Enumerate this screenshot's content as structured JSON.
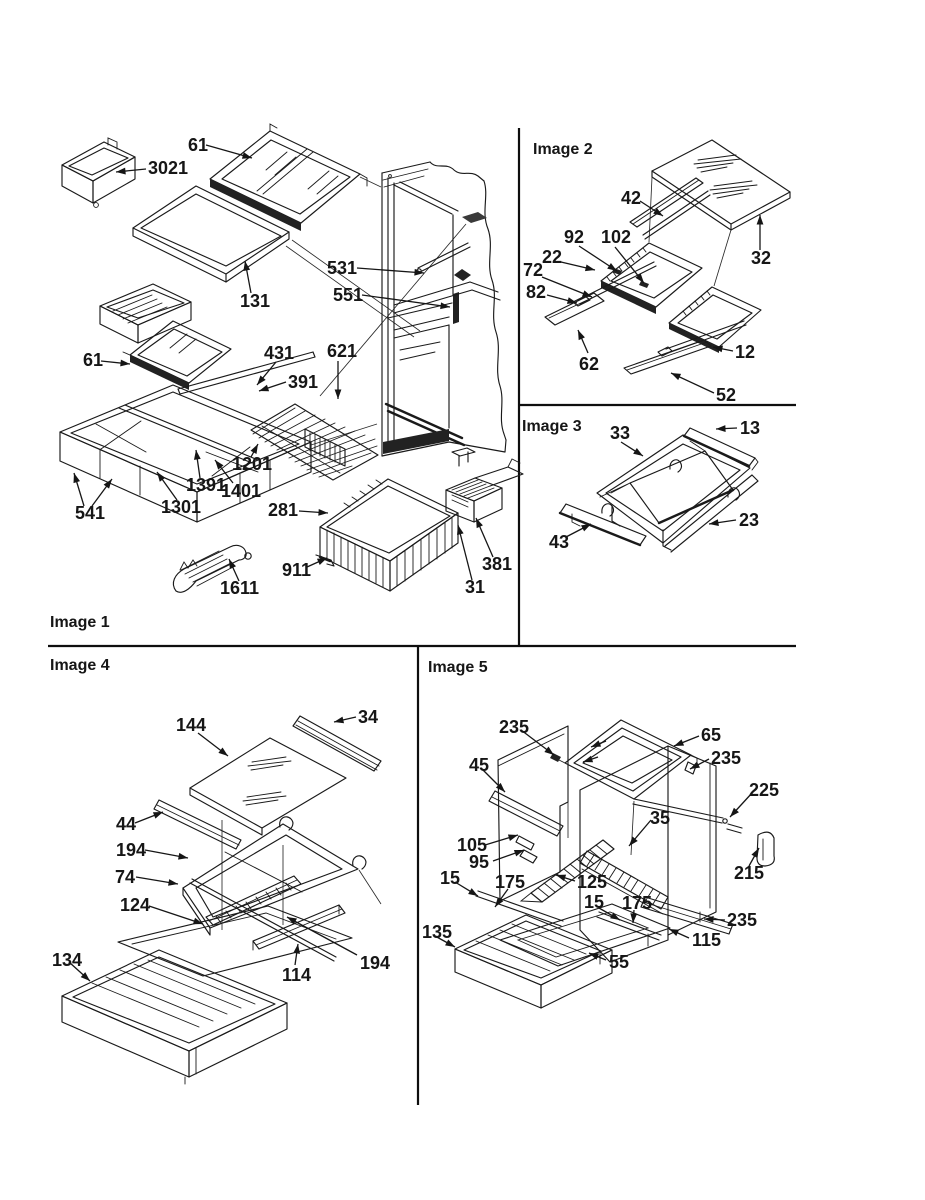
{
  "document": {
    "kind": "appliance exploded parts diagram (scanned line art)",
    "background": "#ffffff",
    "ink": "#1a1a1a"
  },
  "panels": [
    {
      "id": "image-1",
      "label": "Image 1",
      "parts": [
        "61",
        "3021",
        "131",
        "531",
        "551",
        "431",
        "621",
        "391",
        "61",
        "1201",
        "1391",
        "1401",
        "1301",
        "541",
        "281",
        "911",
        "1611",
        "381",
        "31"
      ]
    },
    {
      "id": "image-2",
      "label": "Image 2",
      "parts": [
        "42",
        "92",
        "102",
        "22",
        "72",
        "82",
        "32",
        "62",
        "12",
        "52"
      ]
    },
    {
      "id": "image-3",
      "label": "Image 3",
      "parts": [
        "33",
        "13",
        "43",
        "23"
      ]
    },
    {
      "id": "image-4",
      "label": "Image 4",
      "parts": [
        "144",
        "34",
        "44",
        "194",
        "74",
        "124",
        "134",
        "114",
        "194"
      ]
    },
    {
      "id": "image-5",
      "label": "Image 5",
      "parts": [
        "235",
        "65",
        "235",
        "45",
        "225",
        "35",
        "105",
        "95",
        "15",
        "175",
        "125",
        "15",
        "175",
        "215",
        "235",
        "115",
        "135",
        "55"
      ]
    }
  ]
}
